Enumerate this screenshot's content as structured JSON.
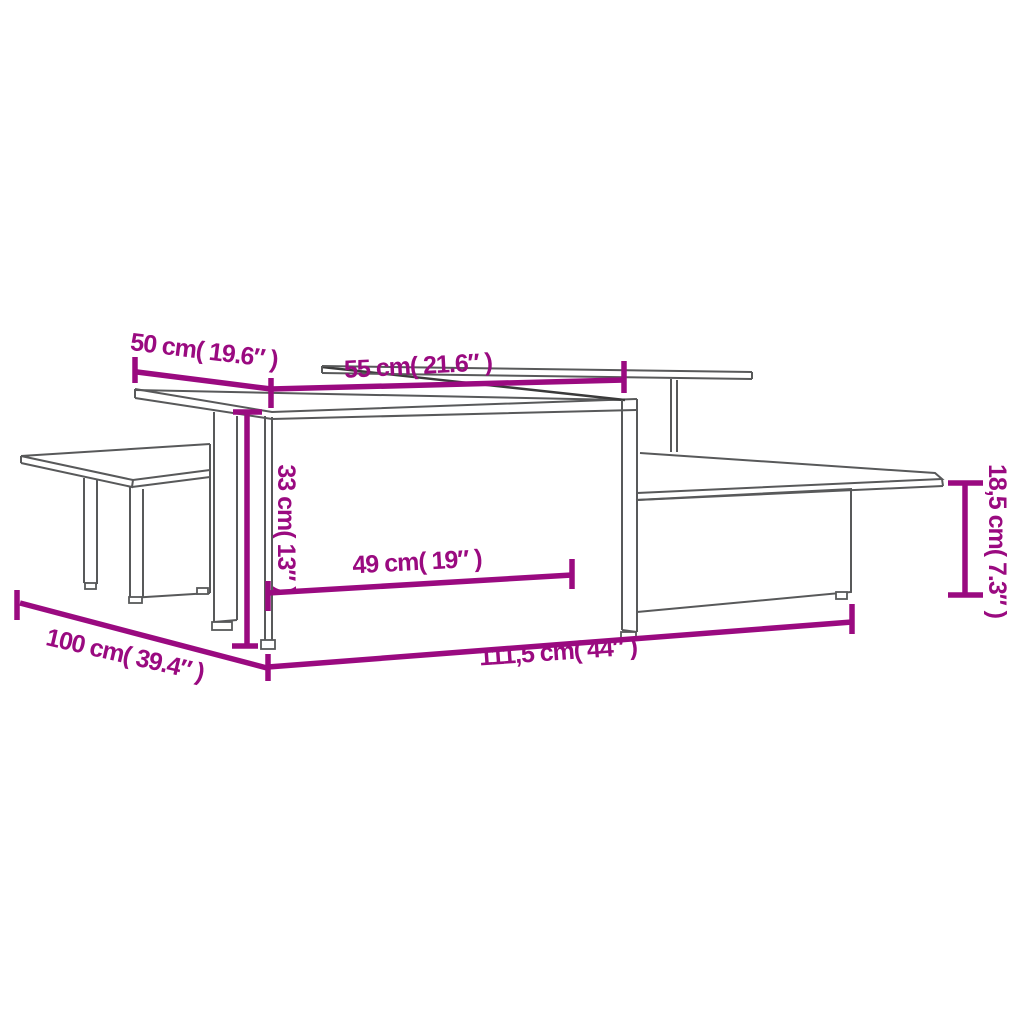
{
  "diagram": {
    "type": "furniture-dimension-diagram",
    "subject": "nesting coffee tables line drawing with dimensions",
    "accent_color": "#9A0A80",
    "line_color": "#58595a",
    "background_color": "#ffffff",
    "measurements": {
      "top_depth_left": {
        "label": "50 cm( 19.6″ )"
      },
      "top_depth_right": {
        "label": "55 cm( 21.6″ )"
      },
      "height_tall": {
        "label": "33 cm( 13″ )"
      },
      "inner_clearance": {
        "label": "49 cm( 19″ )"
      },
      "table_length": {
        "label": "100 cm( 39.4″ )"
      },
      "combined_length": {
        "label": "111,5 cm( 44″ )"
      },
      "height_low": {
        "label": "18,5 cm( 7.3″ )"
      }
    }
  }
}
